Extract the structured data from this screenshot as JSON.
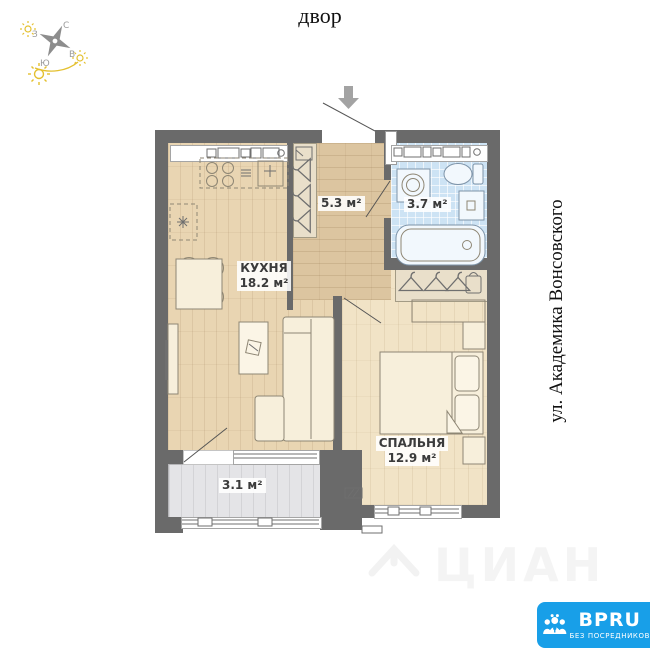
{
  "top": {
    "courtyard_label": "двор"
  },
  "side": {
    "street_label": "ул. Академика Вонсовского"
  },
  "compass": {
    "north": "С",
    "south": "Ю",
    "west": "З",
    "east": "В"
  },
  "rooms": {
    "kitchen": {
      "name": "КУХНЯ",
      "area": "18.2 м²"
    },
    "hallway": {
      "area": "5.3 м²"
    },
    "bathroom": {
      "area": "3.7 м²"
    },
    "bedroom": {
      "name": "СПАЛЬНЯ",
      "area": "12.9 м²"
    },
    "balcony": {
      "area": "3.1 м²"
    }
  },
  "watermark": {
    "text": "ЦИАН"
  },
  "logo": {
    "brand": "BPRU",
    "tagline": "БЕЗ ПОСРЕДНИКОВ"
  },
  "colors": {
    "wall": "#6a6a6a",
    "kitchen_floor": "#e9d5b2",
    "hallway_floor": "#dcc5a0",
    "bedroom_floor": "#f1e3c6",
    "bathroom_floor": "#cde3f4",
    "balcony_floor": "#e4e4e7",
    "closet": "#e9dfca",
    "furniture_stroke": "#8e8674",
    "accent_arc": "#e4c02f",
    "compass_star": "#8d8d8d",
    "label_text": "#3b3b3b",
    "logo_bg": "#189fe8"
  }
}
